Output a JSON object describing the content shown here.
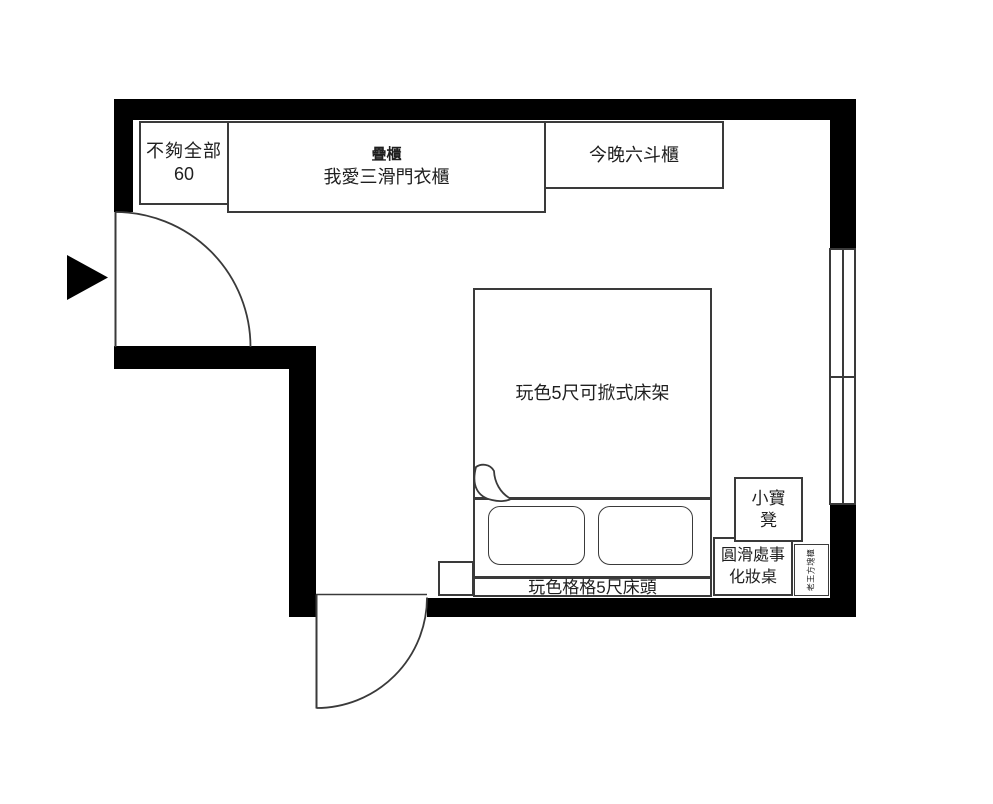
{
  "plan": {
    "colors": {
      "wall": "#000000",
      "line": "#3a3a3a",
      "background": "#ffffff",
      "text": "#1f1f1f"
    },
    "icons": {
      "entry_arrow": "solid black right-pointing triangle marking entry door",
      "blanket_fold": "page-curl fold symbol at bed corner"
    },
    "furniture": {
      "shelf": {
        "line1": "不夠全部",
        "line2": "60"
      },
      "wardrobe": {
        "line1": "疊櫃",
        "line2": "我愛三滑門衣櫃"
      },
      "dresser": {
        "label": "今晚六斗櫃"
      },
      "bed": {
        "label": "玩色5尺可掀式床架"
      },
      "headboard": {
        "label": "玩色格格5尺床頭"
      },
      "stool": {
        "line1": "小寶",
        "line2": "凳"
      },
      "makeup_table": {
        "line1": "圓滑處事",
        "line2": "化妝桌"
      },
      "side_cabinet": {
        "label": "老王方塊櫃"
      }
    }
  }
}
